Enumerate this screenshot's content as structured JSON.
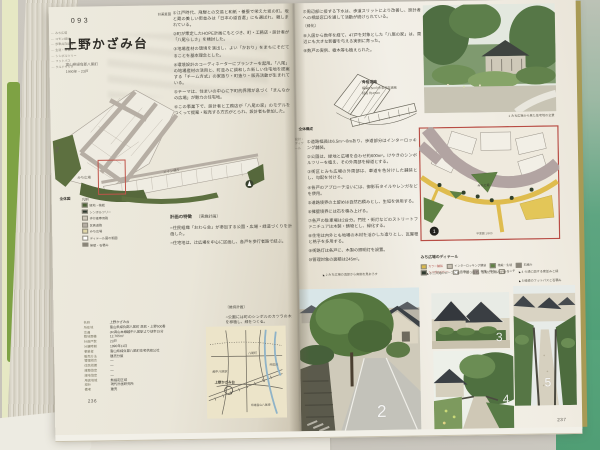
{
  "colors": {
    "accent_red": "#b84c44",
    "plan_green": "#5d7040",
    "road_gray": "#b3aba1",
    "map_yellow": "#dfbc4e",
    "cover_green": "#55a078"
  },
  "left_page": {
    "page_number": "236",
    "margin_index": [
      "みち広場",
      "コモン緑地",
      "歩車共存道路",
      "生垣・石積み",
      "シンボルツリー",
      "フットパス",
      "クルドサック"
    ],
    "project_number": "093",
    "title": "上野かざみ台",
    "subtitle_line1": "富山県婦負郡八尾町",
    "subtitle_line2": "1990年・23戸",
    "plan_intent": {
      "heading": "計画意図",
      "items": [
        "①江戸時代、飛騨との交易と和紙・養蚕で栄えた坂の町。坂と蔵の美しい街並みは「日本の道百選」にも選ばれ、親しまれている。",
        "②町が策定したHOPE計画にもとづき、町・工務店・設計者が「八尾らしさ」を検討した。",
        "③地場産材の環境を演出し、よい「かおり」をまちにそだてることを基本理念とした。",
        "④環境設計のコーディネーターにプランナーを起用。「八尾」の地場産材の活用と、町並みに調和した新しい住宅地を提案する「チーム方式」の家造り・町造り・販売活動が生まれている。",
        "⑤テーマは、住まいの中心に下町的界隈が息づく「まんなかの広場」が魅力の住宅地。",
        "⑥この事業下で、設計者と工務店が「八尾の家」のモデルをつくって提案・販売する方式がとられ、設計者も参加した。"
      ]
    },
    "site_plan": {
      "caption": "全体図",
      "label_michi": "みち広場",
      "label_main": "メイン通り",
      "label_green": "緑道",
      "legend_title": "凡例",
      "legend_items": [
        {
          "label": "緑地・植栽",
          "chip": "#4e6538"
        },
        {
          "label": "シンボルツリー",
          "chip": "#2f3a2f"
        },
        {
          "label": "歩行者専用路",
          "chip": "#cfc8ba"
        },
        {
          "label": "区画道路",
          "chip": "#b6aea4"
        },
        {
          "label": "みち広場",
          "chip": "#e0d6a8"
        },
        {
          "label": "ディテール図の範囲",
          "chip": "#ffffff"
        },
        {
          "label": "擁壁・石積み",
          "chip": "#8a8478"
        }
      ]
    },
    "features": {
      "heading": "計画の特徴",
      "subheading": "〔実施計画〕",
      "items": [
        "○住民組織「おわら会」が参加する公園・広場・緑道づくりを計画した。",
        "○住宅地は、辻広場を中心に区画し、各戸を歩行者路で結ぶ。"
      ]
    },
    "maintenance": {
      "heading": "〔維持計画〕",
      "items": [
        "○公園には町のシンボルのカツラの木を移植し、緑をつくる。"
      ]
    },
    "data_table": {
      "rows": [
        [
          "名称",
          "上野かざみ台"
        ],
        [
          "所在地",
          "富山県婦負郡八尾町 高熊・上野500番"
        ],
        [
          "交通",
          "JR高山本線越中八尾駅より徒歩15分"
        ],
        [
          "敷地面積",
          "12,765m²"
        ],
        [
          "計画戸数",
          "23戸"
        ],
        [
          "分譲時期",
          "1990年11月"
        ],
        [
          "事業者",
          "富山県婦負郡八尾町住宅供給公社"
        ],
        [
          "販売方法",
          "建売分譲"
        ],
        [
          "管理組合",
          "—"
        ],
        [
          "住民組織",
          "—"
        ],
        [
          "建築協定",
          "—"
        ],
        [
          "緑地協定",
          "—"
        ],
        [
          "用途地域",
          "無指定区域"
        ],
        [
          "設計",
          "現代計画研究所"
        ],
        [
          "備考",
          "建売"
        ]
      ]
    },
    "location_map": {
      "label_site": "上野かざみ台",
      "label_station": "越中八尾駅",
      "label_river": "井田川",
      "label_town": "八尾町",
      "label_road": "県道富山八尾線"
    }
  },
  "right_page": {
    "page_number": "237",
    "top_text": {
      "item7": "⑦周辺部に接する下水は、歩道スリットにより改善し、設計者への相談窓口を通して活動が続けられている。",
      "heading_green": "〔緑化〕",
      "item8": "⑧入居から数年を経て、47戸を対象とした「八尾の家」は、周辺にも大きな影響を与える実例に育った。",
      "item9": "⑨数戸の実例、樹木等も植えられた。"
    },
    "margin_label": "設計・ディテール",
    "skeleton": {
      "caption": "全体構成",
      "label": "骨格道路",
      "note1": "幅員6.5mの歩車共存道路",
      "note2": "延長 約470m"
    },
    "photo1_caption": "1 みち広場から見た住宅地の全景",
    "details": {
      "items": [
        "①道路幅員は6.5m〜8mあり、歩道部分はインターロッキング舗装。",
        "②公園は、緑地と広場を合わせ約600m²。けやきのシンボルツリーを植え、その外周部を緑道とする。",
        "③街区とみち広場の外周部は、車道を色分けした舗装とし、勾配を付ける。",
        "④各戸のアプローチ沿いには、御影石タイルやレンガなどを使用。",
        "⑤道路境界の土留めは自然石積みとし、生垣を併用する。",
        "⑥擁壁境界には石を積み上げる。",
        "⑦各戸の駐車場は2台分。門柱・街灯などのストリートファニチュアは木製・鋳物とし、緑化する。",
        "⑧住宅は内外とも地場の木材を活かした造りとし、瓦屋根と格子を多用する。",
        "⑨街路灯は各戸に、木製の照明灯を設置。",
        "⑩管理対象の面積は245m²。"
      ]
    },
    "detail_map": {
      "title": "みち広場のディテール",
      "label_center": "みち広場",
      "scale_note": "平面図 1/500",
      "marker": "1",
      "legend_items": [
        {
          "label": "カラー舗装",
          "chip": "#d9b84a"
        },
        {
          "label": "インターロッキング舗装",
          "chip": "#c9c2b4"
        },
        {
          "label": "植栽・生垣",
          "chip": "#5f8144"
        },
        {
          "label": "石積み",
          "chip": "#8a8478"
        },
        {
          "label": "シンボルツリー",
          "chip": "#2f3a2f"
        },
        {
          "label": "街路灯",
          "chip": "#ffffff"
        },
        {
          "label": "側溝・排水",
          "chip": "#b2a4a2"
        },
        {
          "label": "ベンチ",
          "chip": "#efeade"
        }
      ]
    },
    "photo_captions": {
      "cap2": "2 みち広場の頂部から南側を見おろす",
      "cap3": "3 三叉路のカーブに面して建つ住宅。生垣と石積みが整う",
      "cap4": "4 ら通に面する家並みと緑",
      "cap5": "5 緑道のフットパスと石積み"
    },
    "photo_numbers": {
      "n2": "2",
      "n3": "3",
      "n4": "4",
      "n5": "5"
    }
  }
}
